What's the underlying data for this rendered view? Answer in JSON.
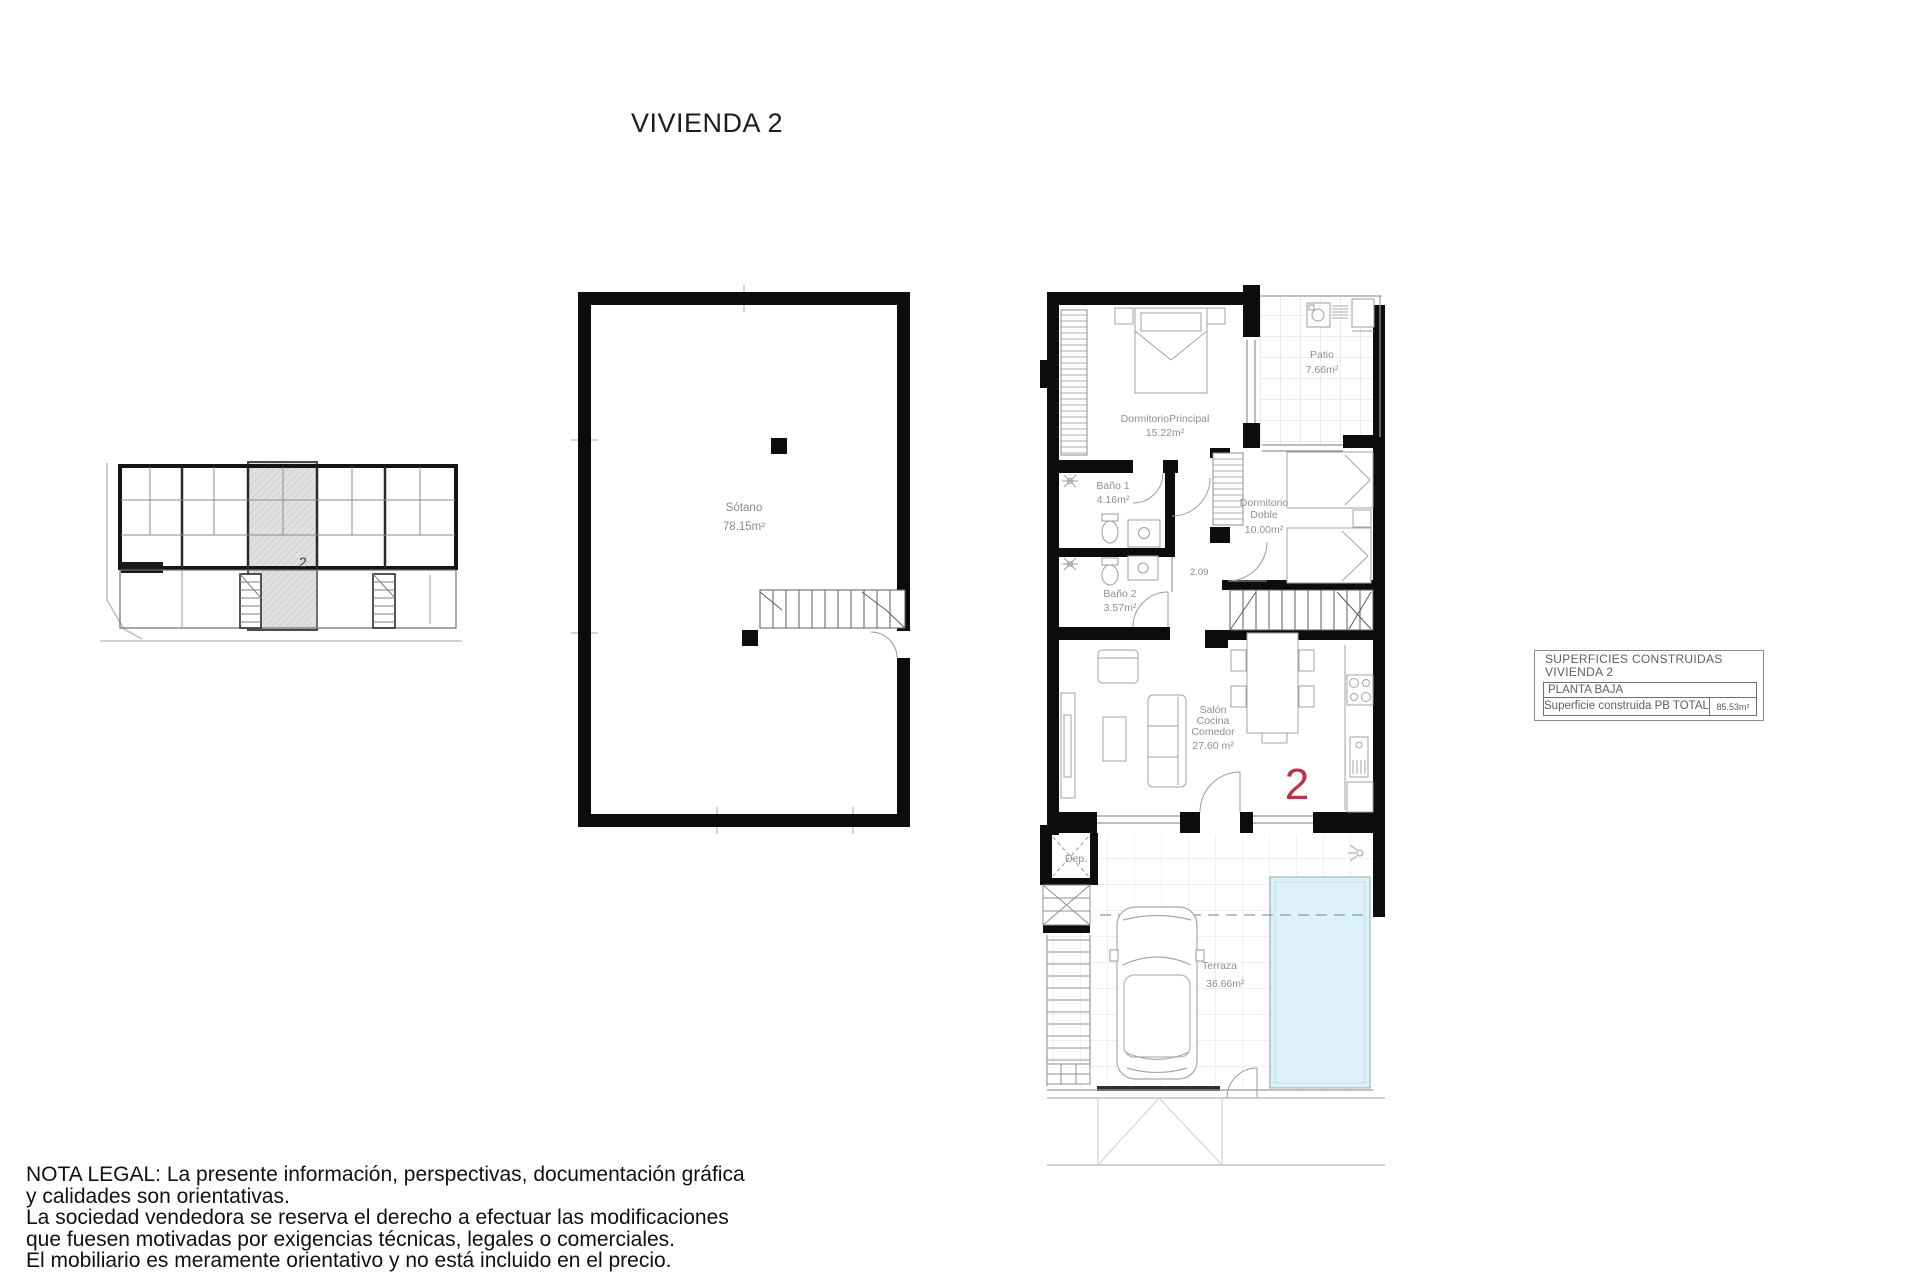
{
  "title": "VIVIENDA 2",
  "key_plan": {
    "unit_label": "2"
  },
  "basement": {
    "room_label": "Sótano",
    "room_area": "78.15m²"
  },
  "planta_baja": {
    "unit_number": "2",
    "dormitorio_principal_label": "DormitorioPrincipal",
    "dormitorio_principal_area": "15.22m²",
    "patio_label": "Patio",
    "patio_area": "7.66m²",
    "bano1_label": "Baño 1",
    "bano1_area": "4.16m²",
    "bano2_label": "Baño 2",
    "bano2_area": "3.57m²",
    "dormitorio_doble_label_line1": "Dormitorio",
    "dormitorio_doble_label_line2": "Doble",
    "dormitorio_doble_area": "10.00m²",
    "salon_label_line1": "Salón",
    "salon_label_line2": "Cocina",
    "salon_label_line3": "Comedor",
    "salon_area": "27.60 m²",
    "terraza_label": "Terraza",
    "terraza_area": "36.66m²",
    "dep_label": "Dep.",
    "stair_dim": "2.09"
  },
  "legend": {
    "title_line1": "SUPERFICIES CONSTRUIDAS",
    "title_line2": "VIVIENDA 2",
    "row_planta": "PLANTA BAJA",
    "row_total_label": "Superficie construida PB TOTAL",
    "row_total_value": "85.53m²"
  },
  "legal_note": {
    "lines": [
      "NOTA LEGAL: La presente información, perspectivas, documentación gráfica",
      "y calidades son orientativas.",
      "La sociedad vendedora se reserva el derecho a efectuar las modificaciones",
      "que fuesen motivadas por exigencias técnicas, legales o comerciales.",
      "El mobiliario es meramente orientativo y no está incluido en el precio."
    ]
  },
  "colors": {
    "accent_red": "#bf3048",
    "pool_fill": "#ddf1f9",
    "wall_black": "#0c0c0c"
  }
}
